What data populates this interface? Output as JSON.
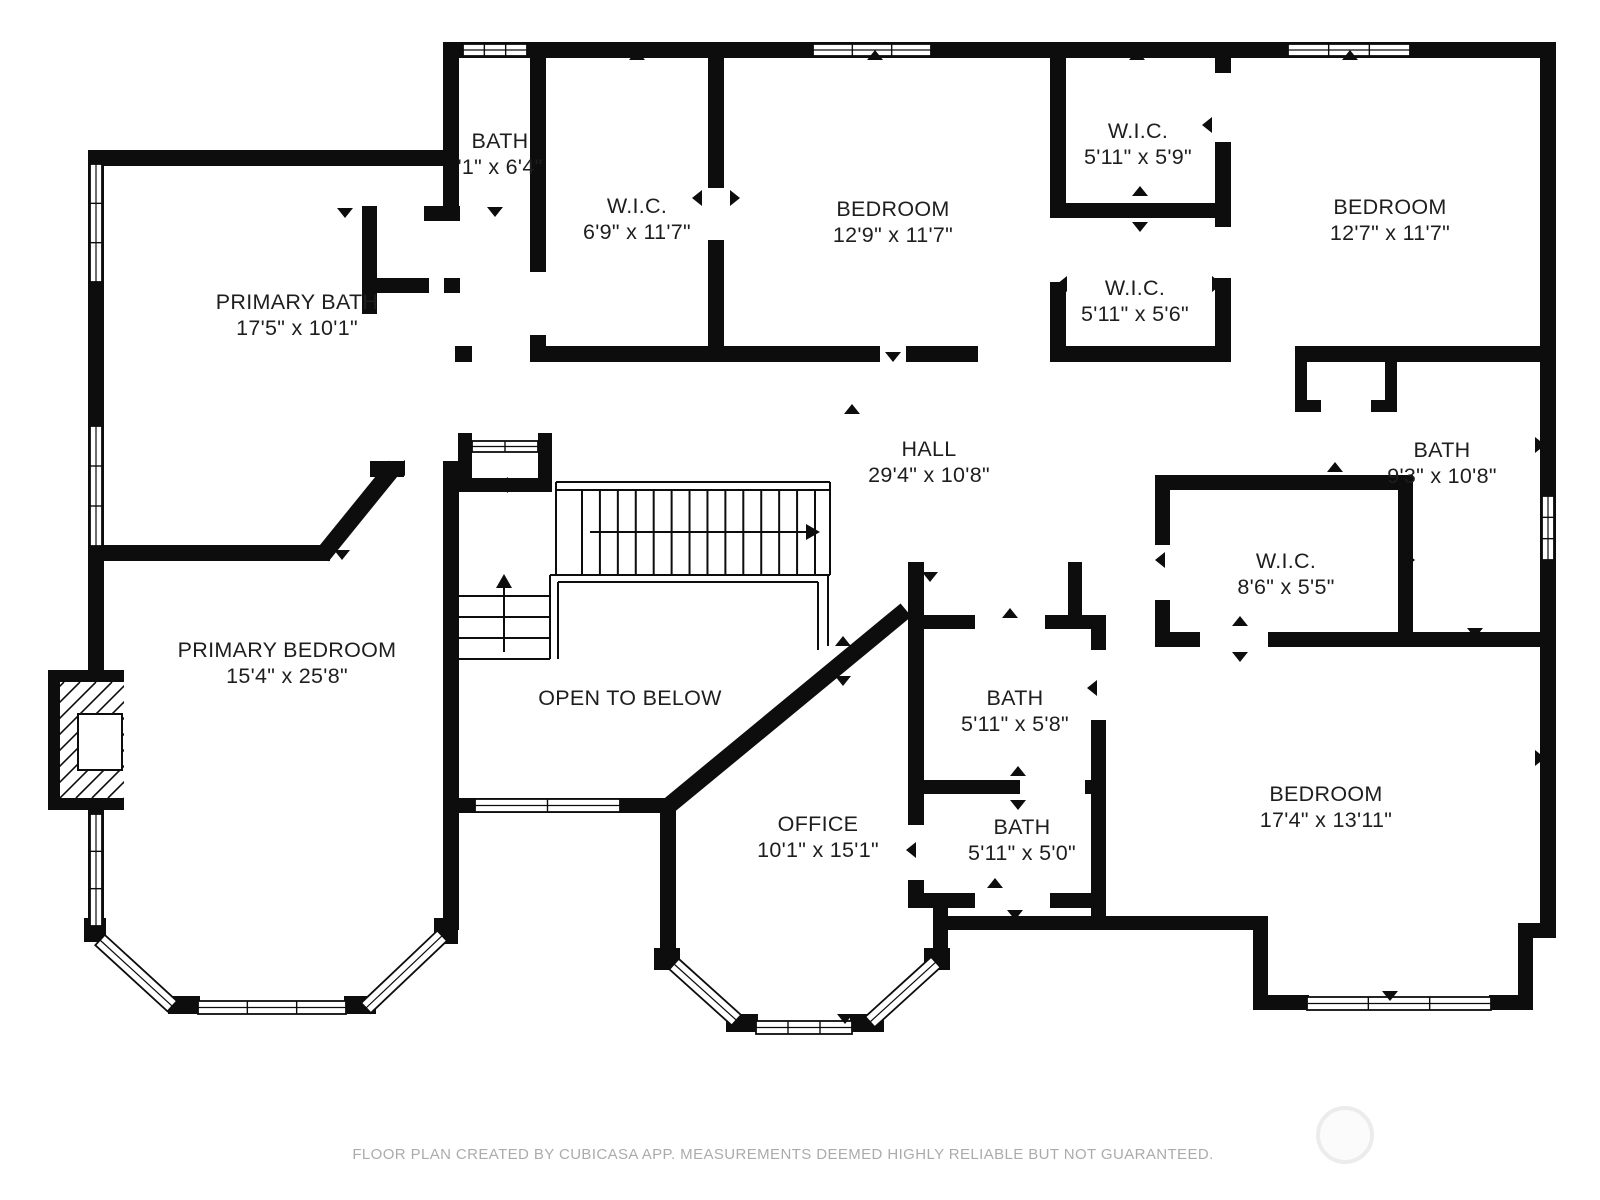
{
  "meta": {
    "footer_text": "FLOOR PLAN CREATED BY CUBICASA APP. MEASUREMENTS DEEMED HIGHLY RELIABLE BUT NOT GUARANTEED.",
    "colors": {
      "wall": "#0d0d0d",
      "text": "#1e1e1e",
      "footer": "#ababab",
      "background": "#ffffff"
    }
  },
  "rooms": [
    {
      "id": "bath-top",
      "name": "BATH",
      "dims": "'1\" x 6'4\"",
      "x": 500,
      "y": 141
    },
    {
      "id": "wic-top-left",
      "name": "W.I.C.",
      "dims": "6'9\" x 11'7\"",
      "x": 637,
      "y": 206
    },
    {
      "id": "bedroom-top-middle",
      "name": "BEDROOM",
      "dims": "12'9\" x 11'7\"",
      "x": 893,
      "y": 209
    },
    {
      "id": "wic-upper-right",
      "name": "W.I.C.",
      "dims": "5'11\" x 5'9\"",
      "x": 1138,
      "y": 131
    },
    {
      "id": "wic-lower-right",
      "name": "W.I.C.",
      "dims": "5'11\" x 5'6\"",
      "x": 1135,
      "y": 288
    },
    {
      "id": "bedroom-top-right",
      "name": "BEDROOM",
      "dims": "12'7\" x 11'7\"",
      "x": 1390,
      "y": 207
    },
    {
      "id": "primary-bath",
      "name": "PRIMARY BATH",
      "dims": "17'5\" x 10'1\"",
      "x": 297,
      "y": 302
    },
    {
      "id": "hall",
      "name": "HALL",
      "dims": "29'4\" x 10'8\"",
      "x": 929,
      "y": 449
    },
    {
      "id": "bath-right",
      "name": "BATH",
      "dims": "9'3\" x 10'8\"",
      "x": 1442,
      "y": 450
    },
    {
      "id": "wic-bedroom",
      "name": "W.I.C.",
      "dims": "8'6\" x 5'5\"",
      "x": 1286,
      "y": 561
    },
    {
      "id": "primary-bedroom",
      "name": "PRIMARY BEDROOM",
      "dims": "15'4\" x 25'8\"",
      "x": 287,
      "y": 650
    },
    {
      "id": "open-to-below",
      "name": "OPEN TO BELOW",
      "dims": null,
      "x": 630,
      "y": 698
    },
    {
      "id": "office",
      "name": "OFFICE",
      "dims": "10'1\" x 15'1\"",
      "x": 818,
      "y": 824
    },
    {
      "id": "bath-mid-upper",
      "name": "BATH",
      "dims": "5'11\" x 5'8\"",
      "x": 1015,
      "y": 698
    },
    {
      "id": "bath-mid-lower",
      "name": "BATH",
      "dims": "5'11\" x 5'0\"",
      "x": 1022,
      "y": 827
    },
    {
      "id": "bedroom-bottom-right",
      "name": "BEDROOM",
      "dims": "17'4\" x 13'11\"",
      "x": 1326,
      "y": 794
    }
  ],
  "geometry": {
    "walls": [
      {
        "x": 443,
        "y": 42,
        "w": 1113,
        "h": 16
      },
      {
        "x": 1540,
        "y": 42,
        "w": 16,
        "h": 896
      },
      {
        "x": 88,
        "y": 150,
        "w": 16,
        "h": 524
      },
      {
        "x": 88,
        "y": 806,
        "w": 16,
        "h": 126
      },
      {
        "x": 88,
        "y": 150,
        "w": 370,
        "h": 16
      },
      {
        "x": 443,
        "y": 42,
        "w": 16,
        "h": 172
      },
      {
        "x": 424,
        "y": 206,
        "w": 36,
        "h": 15
      },
      {
        "x": 362,
        "y": 206,
        "w": 15,
        "h": 108
      },
      {
        "x": 377,
        "y": 278,
        "w": 52,
        "h": 15
      },
      {
        "x": 444,
        "y": 278,
        "w": 16,
        "h": 15
      },
      {
        "x": 104,
        "y": 545,
        "w": 226,
        "h": 16
      },
      {
        "x": 370,
        "y": 461,
        "w": 34,
        "h": 16
      },
      {
        "x": 530,
        "y": 42,
        "w": 16,
        "h": 230
      },
      {
        "x": 530,
        "y": 335,
        "w": 16,
        "h": 27
      },
      {
        "x": 708,
        "y": 58,
        "w": 16,
        "h": 130
      },
      {
        "x": 708,
        "y": 240,
        "w": 16,
        "h": 122
      },
      {
        "x": 455,
        "y": 346,
        "w": 17,
        "h": 16
      },
      {
        "x": 530,
        "y": 346,
        "w": 180,
        "h": 16
      },
      {
        "x": 724,
        "y": 346,
        "w": 156,
        "h": 16
      },
      {
        "x": 906,
        "y": 346,
        "w": 72,
        "h": 16
      },
      {
        "x": 1050,
        "y": 346,
        "w": 178,
        "h": 16
      },
      {
        "x": 1295,
        "y": 346,
        "w": 250,
        "h": 16
      },
      {
        "x": 1050,
        "y": 58,
        "w": 16,
        "h": 160
      },
      {
        "x": 1050,
        "y": 282,
        "w": 16,
        "h": 80
      },
      {
        "x": 1215,
        "y": 58,
        "w": 16,
        "h": 15
      },
      {
        "x": 1215,
        "y": 142,
        "w": 16,
        "h": 85
      },
      {
        "x": 1215,
        "y": 278,
        "w": 16,
        "h": 84
      },
      {
        "x": 1050,
        "y": 203,
        "w": 181,
        "h": 15
      },
      {
        "x": 1295,
        "y": 362,
        "w": 12,
        "h": 50
      },
      {
        "x": 1385,
        "y": 362,
        "w": 12,
        "h": 48
      },
      {
        "x": 1295,
        "y": 400,
        "w": 26,
        "h": 12
      },
      {
        "x": 1371,
        "y": 400,
        "w": 26,
        "h": 12
      },
      {
        "x": 1155,
        "y": 475,
        "w": 258,
        "h": 15
      },
      {
        "x": 1155,
        "y": 490,
        "w": 15,
        "h": 55
      },
      {
        "x": 1155,
        "y": 600,
        "w": 15,
        "h": 43
      },
      {
        "x": 1398,
        "y": 490,
        "w": 15,
        "h": 153
      },
      {
        "x": 1155,
        "y": 632,
        "w": 45,
        "h": 15
      },
      {
        "x": 1268,
        "y": 632,
        "w": 145,
        "h": 15
      },
      {
        "x": 1413,
        "y": 632,
        "w": 132,
        "h": 15
      },
      {
        "x": 908,
        "y": 562,
        "w": 16,
        "h": 263
      },
      {
        "x": 908,
        "y": 880,
        "w": 16,
        "h": 28
      },
      {
        "x": 1068,
        "y": 562,
        "w": 14,
        "h": 53
      },
      {
        "x": 924,
        "y": 615,
        "w": 51,
        "h": 14
      },
      {
        "x": 1045,
        "y": 615,
        "w": 46,
        "h": 14
      },
      {
        "x": 1091,
        "y": 615,
        "w": 15,
        "h": 35
      },
      {
        "x": 1091,
        "y": 720,
        "w": 15,
        "h": 185
      },
      {
        "x": 924,
        "y": 780,
        "w": 96,
        "h": 14
      },
      {
        "x": 1085,
        "y": 780,
        "w": 21,
        "h": 14
      },
      {
        "x": 908,
        "y": 893,
        "w": 67,
        "h": 15
      },
      {
        "x": 1050,
        "y": 893,
        "w": 56,
        "h": 15
      },
      {
        "x": 948,
        "y": 916,
        "w": 320,
        "h": 14
      },
      {
        "x": 1091,
        "y": 893,
        "w": 15,
        "h": 37
      },
      {
        "x": 443,
        "y": 461,
        "w": 16,
        "h": 469
      },
      {
        "x": 458,
        "y": 433,
        "w": 14,
        "h": 59
      },
      {
        "x": 538,
        "y": 433,
        "w": 14,
        "h": 59
      },
      {
        "x": 458,
        "y": 478,
        "w": 94,
        "h": 14
      },
      {
        "x": 459,
        "y": 798,
        "w": 214,
        "h": 15
      },
      {
        "x": 660,
        "y": 798,
        "w": 16,
        "h": 160
      },
      {
        "x": 933,
        "y": 893,
        "w": 15,
        "h": 67
      },
      {
        "x": 1253,
        "y": 930,
        "w": 15,
        "h": 80
      },
      {
        "x": 1253,
        "y": 995,
        "w": 56,
        "h": 15
      },
      {
        "x": 1489,
        "y": 995,
        "w": 44,
        "h": 15
      },
      {
        "x": 1518,
        "y": 930,
        "w": 15,
        "h": 80
      },
      {
        "x": 1518,
        "y": 923,
        "w": 38,
        "h": 15
      },
      {
        "x": 84,
        "y": 918,
        "w": 22,
        "h": 24
      },
      {
        "x": 168,
        "y": 996,
        "w": 32,
        "h": 18
      },
      {
        "x": 344,
        "y": 996,
        "w": 32,
        "h": 18
      },
      {
        "x": 434,
        "y": 918,
        "w": 24,
        "h": 26
      },
      {
        "x": 654,
        "y": 948,
        "w": 26,
        "h": 22
      },
      {
        "x": 726,
        "y": 1014,
        "w": 32,
        "h": 18
      },
      {
        "x": 850,
        "y": 1014,
        "w": 34,
        "h": 18
      },
      {
        "x": 924,
        "y": 948,
        "w": 26,
        "h": 22
      }
    ],
    "diagonal_walls": [
      {
        "x1": 322,
        "y1": 556,
        "x2": 395,
        "y2": 466,
        "w": 17
      },
      {
        "x1": 666,
        "y1": 808,
        "x2": 906,
        "y2": 610,
        "w": 17
      }
    ],
    "windows": [
      {
        "x": 463,
        "y": 44,
        "w": 64,
        "h": 12,
        "ticks": 2
      },
      {
        "x": 813,
        "y": 44,
        "w": 118,
        "h": 12,
        "ticks": 2
      },
      {
        "x": 1288,
        "y": 44,
        "w": 122,
        "h": 12,
        "ticks": 2
      },
      {
        "x": 90,
        "y": 164,
        "w": 12,
        "h": 118,
        "ticks": 2
      },
      {
        "x": 90,
        "y": 426,
        "w": 12,
        "h": 120,
        "ticks": 2
      },
      {
        "x": 90,
        "y": 814,
        "w": 12,
        "h": 112,
        "ticks": 2
      },
      {
        "x": 1542,
        "y": 496,
        "w": 12,
        "h": 64,
        "ticks": 2
      },
      {
        "x": 472,
        "y": 441,
        "w": 66,
        "h": 11,
        "ticks": 1
      },
      {
        "x": 475,
        "y": 799,
        "w": 145,
        "h": 13,
        "ticks": 1
      },
      {
        "x": 198,
        "y": 1001,
        "w": 148,
        "h": 13,
        "ticks": 2
      },
      {
        "x": 756,
        "y": 1021,
        "w": 96,
        "h": 13,
        "ticks": 2
      },
      {
        "x": 1307,
        "y": 997,
        "w": 184,
        "h": 13,
        "ticks": 2
      }
    ],
    "angled_windows": [
      {
        "x": 100,
        "y": 940,
        "len": 98,
        "angle": 42.5
      },
      {
        "x": 366,
        "y": 1008,
        "len": 105,
        "angle": -43.5
      },
      {
        "x": 674,
        "y": 964,
        "len": 84,
        "angle": 42.0
      },
      {
        "x": 870,
        "y": 1022,
        "len": 89,
        "angle": -42.3
      }
    ],
    "chimney": {
      "outer": {
        "x": 48,
        "y": 670,
        "w": 76,
        "h": 140
      },
      "inner": {
        "x": 60,
        "y": 682,
        "w": 64,
        "h": 116
      },
      "box": {
        "x": 78,
        "y": 714,
        "w": 44,
        "h": 56
      }
    },
    "stairs": {
      "lines": [
        [
          556,
          482,
          830,
          482
        ],
        [
          556,
          490,
          830,
          490
        ],
        [
          556,
          482,
          556,
          575
        ],
        [
          830,
          482,
          830,
          575
        ],
        [
          550,
          575,
          830,
          575
        ],
        [
          459,
          596,
          550,
          596
        ],
        [
          459,
          617,
          550,
          617
        ],
        [
          459,
          638,
          550,
          638
        ],
        [
          459,
          659,
          550,
          659
        ],
        [
          550,
          575,
          550,
          659
        ],
        [
          558,
          582,
          558,
          659
        ],
        [
          558,
          582,
          818,
          582
        ],
        [
          818,
          582,
          818,
          650
        ],
        [
          828,
          575,
          828,
          646
        ]
      ],
      "treads": {
        "x0": 582,
        "x1": 815,
        "n": 14,
        "y0": 490,
        "y1": 575
      },
      "arrows": [
        {
          "x1": 590,
          "y1": 532,
          "x2": 806,
          "y2": 532
        },
        {
          "x1": 504,
          "y1": 652,
          "x2": 504,
          "y2": 588
        }
      ]
    },
    "door_markers": [
      {
        "x": 345,
        "y": 208,
        "d": "down"
      },
      {
        "x": 495,
        "y": 207,
        "d": "down"
      },
      {
        "x": 637,
        "y": 60,
        "d": "up"
      },
      {
        "x": 875,
        "y": 60,
        "d": "up"
      },
      {
        "x": 1137,
        "y": 60,
        "d": "up"
      },
      {
        "x": 1350,
        "y": 60,
        "d": "up"
      },
      {
        "x": 702,
        "y": 198,
        "d": "left"
      },
      {
        "x": 730,
        "y": 198,
        "d": "right"
      },
      {
        "x": 893,
        "y": 352,
        "d": "down"
      },
      {
        "x": 852,
        "y": 414,
        "d": "up"
      },
      {
        "x": 1212,
        "y": 125,
        "d": "left"
      },
      {
        "x": 1140,
        "y": 196,
        "d": "up"
      },
      {
        "x": 1140,
        "y": 222,
        "d": "down"
      },
      {
        "x": 1067,
        "y": 284,
        "d": "left"
      },
      {
        "x": 1212,
        "y": 284,
        "d": "right"
      },
      {
        "x": 1140,
        "y": 352,
        "d": "down"
      },
      {
        "x": 1380,
        "y": 350,
        "d": "down"
      },
      {
        "x": 1535,
        "y": 445,
        "d": "right"
      },
      {
        "x": 1335,
        "y": 472,
        "d": "up"
      },
      {
        "x": 1405,
        "y": 560,
        "d": "right"
      },
      {
        "x": 1165,
        "y": 560,
        "d": "left"
      },
      {
        "x": 1240,
        "y": 626,
        "d": "up"
      },
      {
        "x": 1240,
        "y": 652,
        "d": "down"
      },
      {
        "x": 1475,
        "y": 628,
        "d": "down"
      },
      {
        "x": 1390,
        "y": 645,
        "d": "up"
      },
      {
        "x": 1010,
        "y": 618,
        "d": "up"
      },
      {
        "x": 1097,
        "y": 688,
        "d": "left"
      },
      {
        "x": 916,
        "y": 850,
        "d": "left"
      },
      {
        "x": 1018,
        "y": 776,
        "d": "up"
      },
      {
        "x": 1018,
        "y": 800,
        "d": "down"
      },
      {
        "x": 995,
        "y": 888,
        "d": "up"
      },
      {
        "x": 1015,
        "y": 910,
        "d": "down"
      },
      {
        "x": 845,
        "y": 1014,
        "d": "down"
      },
      {
        "x": 1390,
        "y": 991,
        "d": "down"
      },
      {
        "x": 405,
        "y": 468,
        "d": "left"
      },
      {
        "x": 342,
        "y": 550,
        "d": "down"
      },
      {
        "x": 508,
        "y": 485,
        "d": "left"
      },
      {
        "x": 1535,
        "y": 758,
        "d": "right"
      },
      {
        "x": 843,
        "y": 646,
        "d": "up"
      },
      {
        "x": 843,
        "y": 676,
        "d": "down"
      },
      {
        "x": 930,
        "y": 572,
        "d": "down"
      }
    ]
  }
}
